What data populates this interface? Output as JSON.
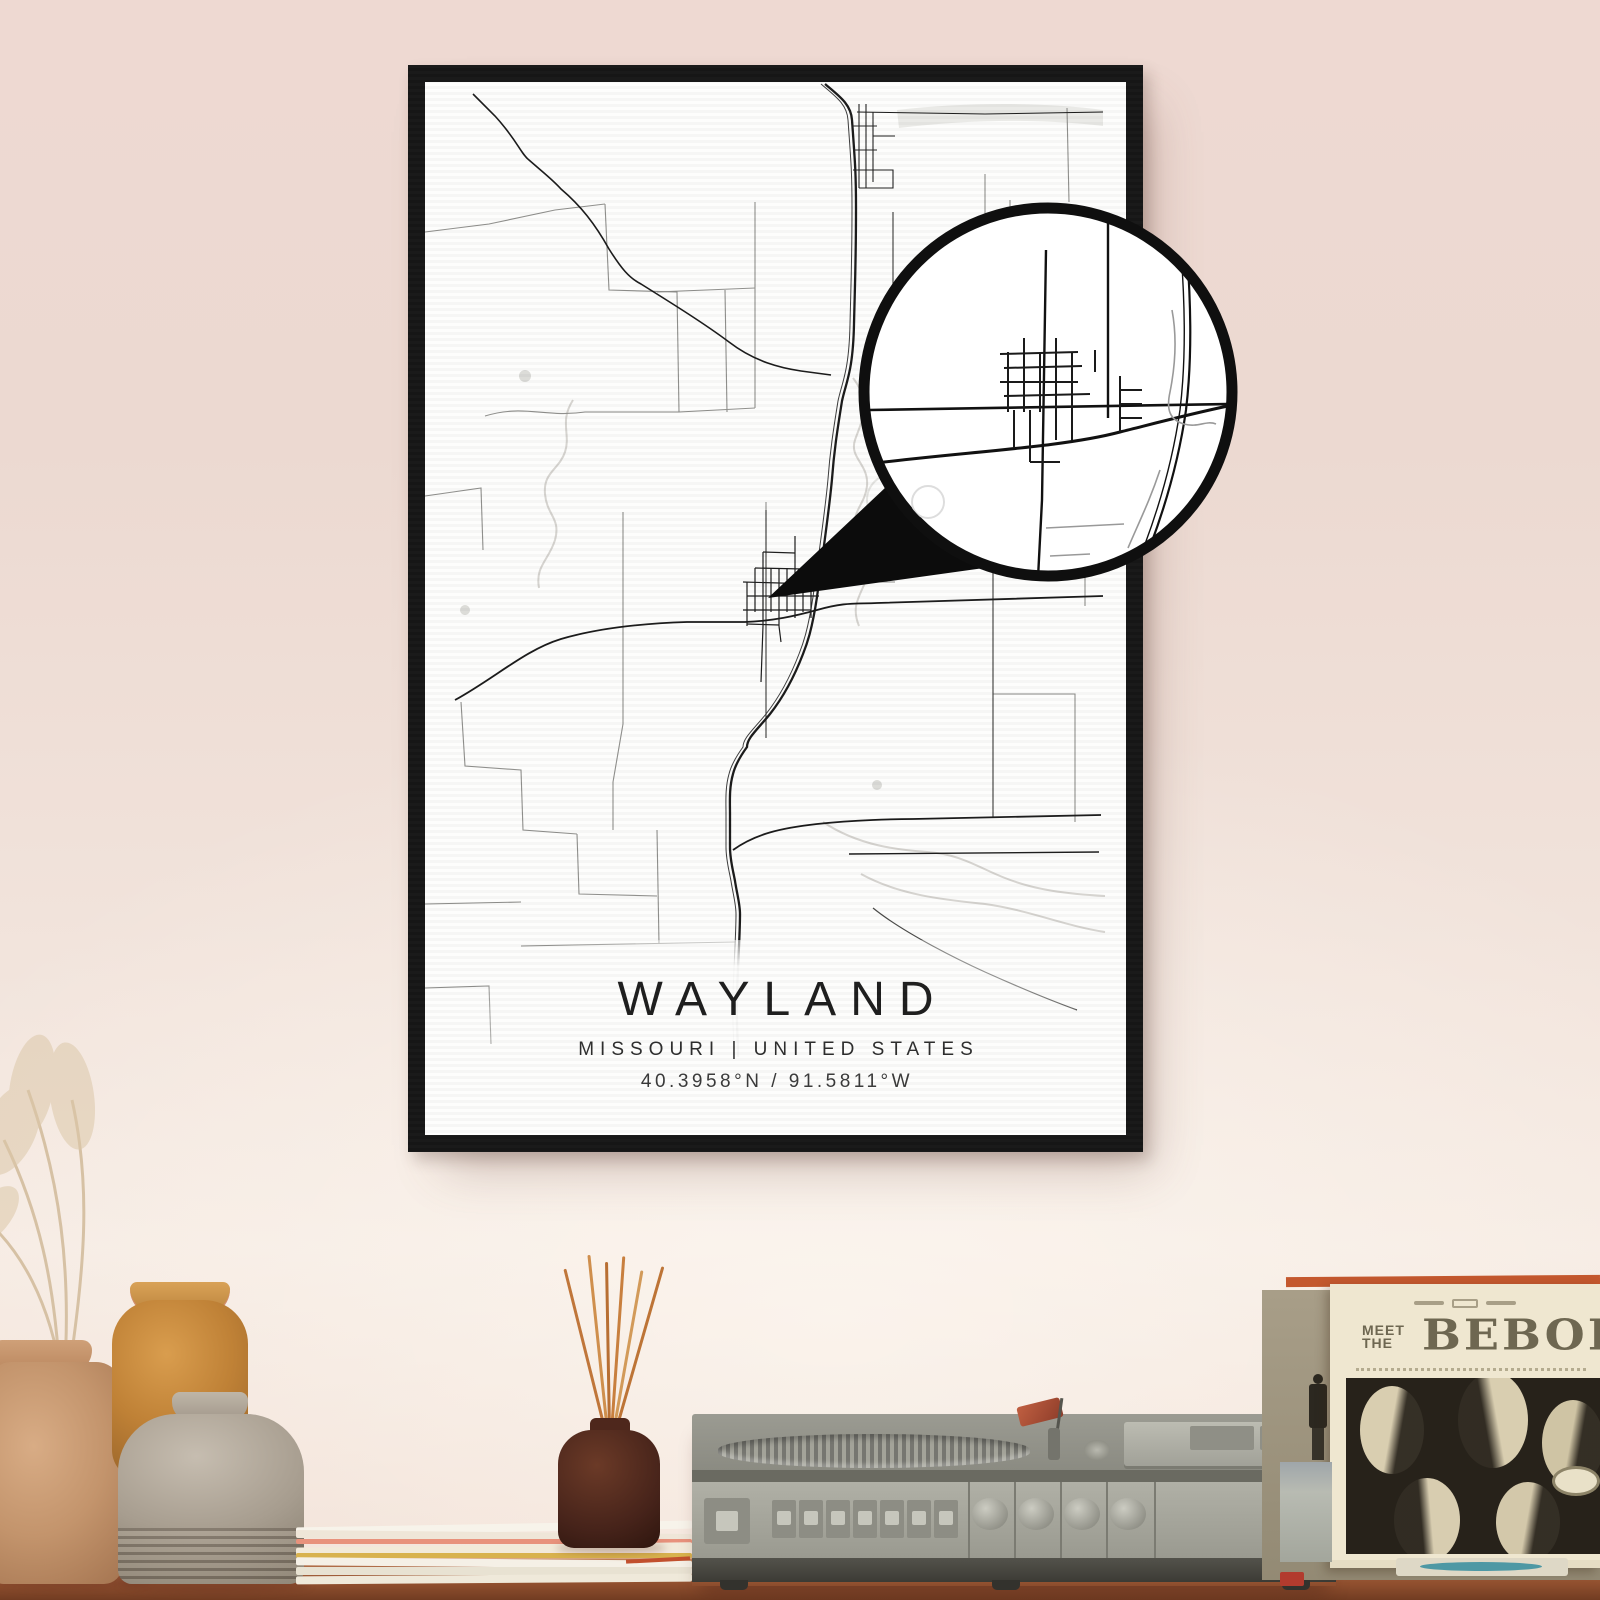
{
  "poster": {
    "title": "WAYLAND",
    "subtitle": "MISSOURI | UNITED STATES",
    "coordinates": "40.3958°N / 91.5811°W"
  },
  "album": {
    "meet": "MEET",
    "the": "THE",
    "title": "BEBOP"
  },
  "colors": {
    "wall-top": "#eed9d2",
    "wall-mid": "#f0e1d9",
    "wall-bottom": "#f6ebe3",
    "frame": "#171717",
    "paper": "#fdfdfc",
    "shelf-top": "#ad6a46",
    "shelf-bottom": "#713c22",
    "vase-tan": "#c3946c",
    "vase-amber": "#bf8136",
    "vase-gray": "#a79d8f",
    "bottle": "#46231a",
    "album-olive": "#a89e88",
    "album-cream": "#efe7d0",
    "album-orange": "#c4582e",
    "album-bg": "#27221a"
  }
}
